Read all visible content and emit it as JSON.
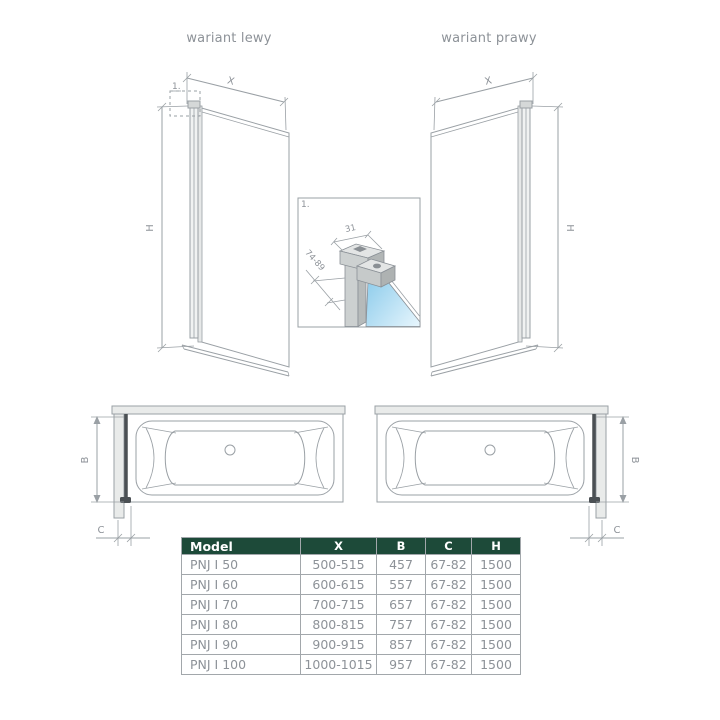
{
  "variant_labels": {
    "left": "wariant lewy",
    "right": "wariant prawy"
  },
  "dimension_labels": {
    "x": "X",
    "h": "H",
    "b": "B",
    "c": "C"
  },
  "detail_labels": {
    "marker": "1.",
    "profile_width": "31",
    "depth_range": "74-89"
  },
  "table": {
    "headers": [
      "Model",
      "X",
      "B",
      "C",
      "H"
    ],
    "rows": [
      {
        "model": "PNJ I 50",
        "x": "500-515",
        "b": "457",
        "c": "67-82",
        "h": "1500"
      },
      {
        "model": "PNJ I 60",
        "x": "600-615",
        "b": "557",
        "c": "67-82",
        "h": "1500"
      },
      {
        "model": "PNJ I 70",
        "x": "700-715",
        "b": "657",
        "c": "67-82",
        "h": "1500"
      },
      {
        "model": "PNJ I 80",
        "x": "800-815",
        "b": "757",
        "c": "67-82",
        "h": "1500"
      },
      {
        "model": "PNJ I 90",
        "x": "900-915",
        "b": "857",
        "c": "67-82",
        "h": "1500"
      },
      {
        "model": "PNJ I 100",
        "x": "1000-1015",
        "b": "957",
        "c": "67-82",
        "h": "1500"
      }
    ]
  },
  "colors": {
    "line": "#9aa0a5",
    "label_text": "#8d9298",
    "table_header_bg": "#1d4a39",
    "table_header_text": "#ffffff",
    "glass_blue": "#7cc4e8",
    "screen_dark": "#4b5054"
  }
}
